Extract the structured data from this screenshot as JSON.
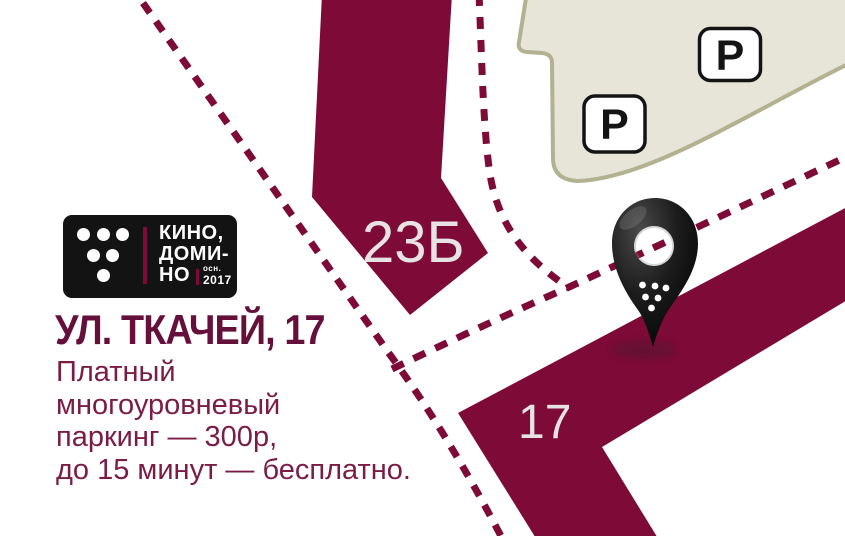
{
  "branding": {
    "logo": {
      "line1": "КИНО,",
      "line2": "ДОМИ-",
      "line3": "НО",
      "founded_label": "осн.",
      "founded_year": "2017"
    },
    "address_title": "УЛ. ТКАЧЕЙ, 17",
    "description_lines": [
      "Платный",
      "многоуровневый",
      "паркинг — 300р,",
      "до 15 минут — бесплатно."
    ]
  },
  "map": {
    "building_labels": {
      "b23": "23Б",
      "b17": "17"
    },
    "parking_badges": [
      {
        "label": "P"
      },
      {
        "label": "P"
      }
    ],
    "colors": {
      "road": "#7d0a37",
      "building_fill": "#e6e5d7",
      "building_stroke": "#b2b190",
      "shape_label": "#e7e2e3",
      "badge_border": "#141414",
      "badge_fill": "#ffffff",
      "pin_black": "#111111",
      "logo_bg": "#131313",
      "accent_bar": "#7d0a37",
      "title_text": "#65103a",
      "body_text": "#7b1c46"
    }
  }
}
